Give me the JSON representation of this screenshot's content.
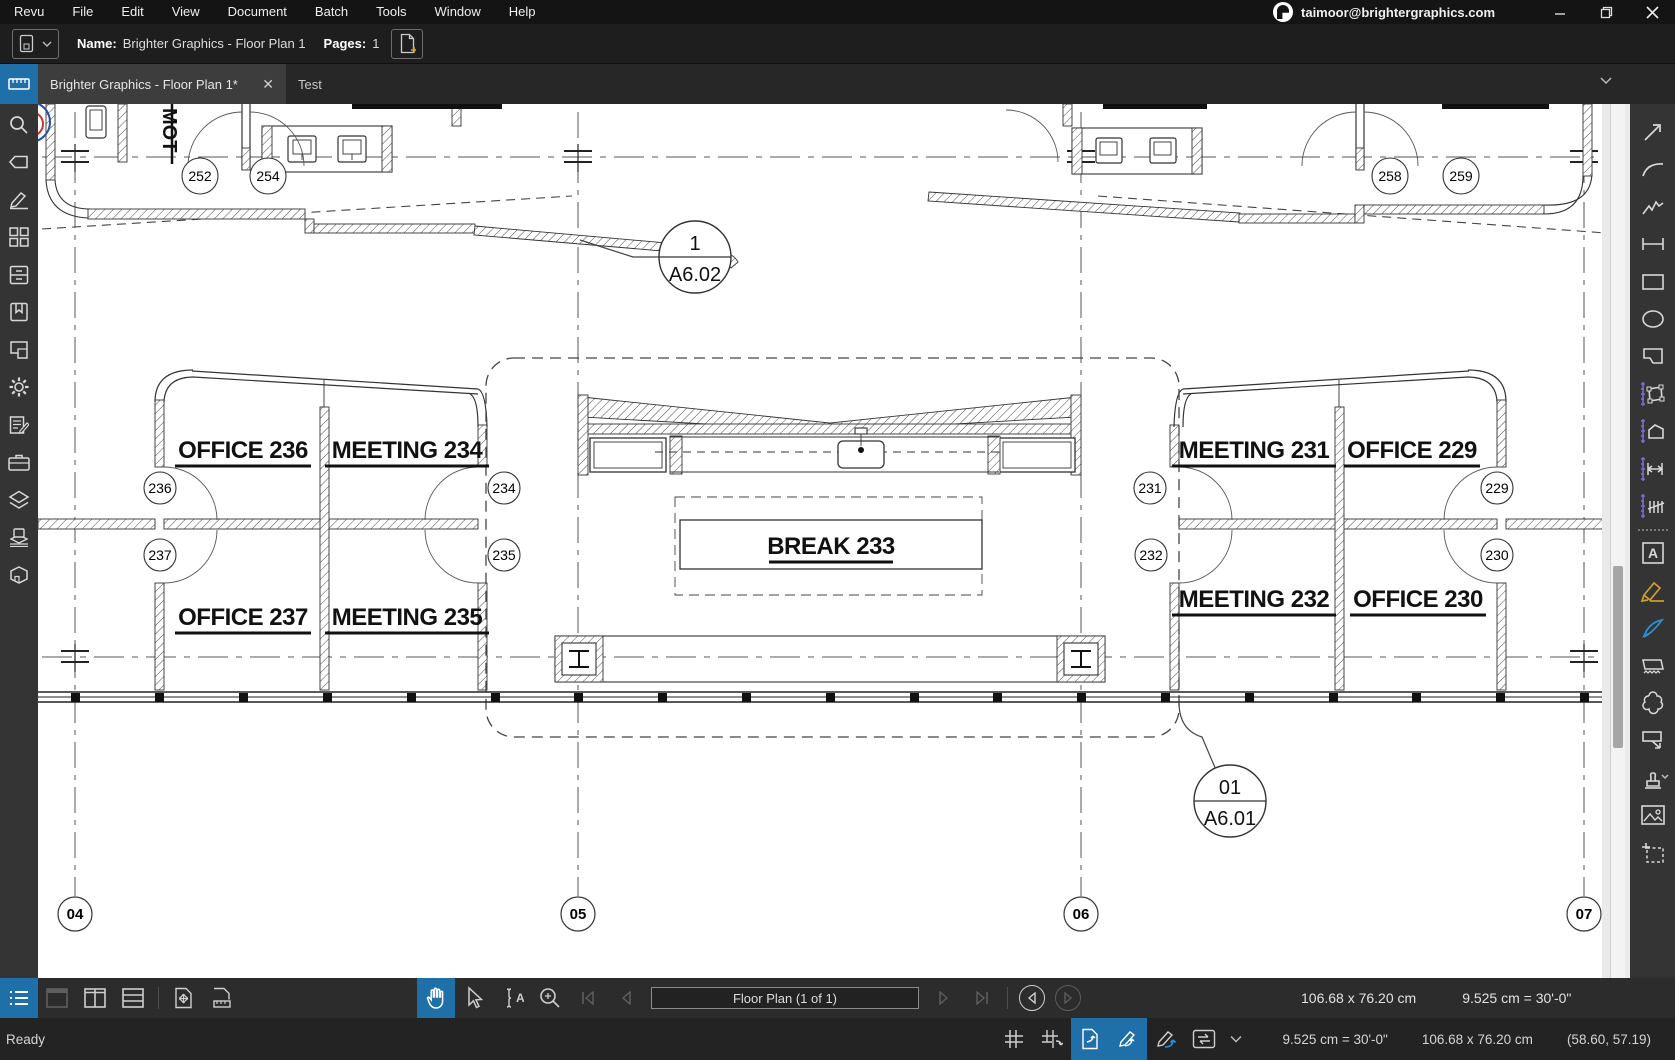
{
  "titlebar": {
    "menus": [
      "Revu",
      "File",
      "Edit",
      "View",
      "Document",
      "Batch",
      "Tools",
      "Window",
      "Help"
    ],
    "account_email": "taimoor@brightergraphics.com",
    "window_icons": [
      "revu-logo",
      "minimize-icon",
      "restore-icon",
      "close-icon"
    ]
  },
  "filebar": {
    "name_label": "Name:",
    "name_value": "Brighter Graphics - Floor Plan 1",
    "pages_label": "Pages:",
    "pages_value": "1",
    "icons": [
      "document-dropdown-icon",
      "new-page-icon"
    ]
  },
  "tabs": {
    "active_label": "Brighter Graphics - Floor Plan 1*",
    "close_glyph": "✕",
    "second_label": "Test",
    "icons": [
      "ruler-tab-icon",
      "chevron-down-icon"
    ]
  },
  "left_panel": {
    "active_icon": "measurements-panel-icon",
    "icons": [
      "search-icon",
      "tag-icon",
      "markup-pen-icon",
      "thumbnails-icon",
      "file-access-icon",
      "bookmarks-icon",
      "spaces-icon",
      "settings-gear-icon",
      "markups-list-icon",
      "tool-chest-icon",
      "layers-icon",
      "sets-icon",
      "3d-model-icon"
    ]
  },
  "right_panel": {
    "icons": [
      "line-icon",
      "arrow-icon",
      "arc-icon",
      "polyline-icon",
      "dimension-icon",
      "rectangle-icon",
      "ellipse-icon",
      "polygon-icon",
      "measure-area-icon",
      "measure-perimeter-icon",
      "measure-length-icon",
      "measure-count-icon",
      "text-box-icon",
      "highlighter-icon",
      "pen-icon",
      "eraser-icon",
      "cloud-icon",
      "callout-icon",
      "stamp-icon",
      "image-icon",
      "snapshot-icon"
    ],
    "accent_purple": "#7b6ed6"
  },
  "toolbar_bottom": {
    "page_field": "Floor Plan (1 of 1)",
    "dims": "106.68 x 76.20 cm",
    "scale": "9.525 cm = 30'-0\"",
    "icons": [
      "markups-list-toggle-icon",
      "single-pane-icon",
      "split-vertical-icon",
      "split-horizontal-icon",
      "fit-page-icon",
      "fit-width-icon",
      "pan-hand-icon",
      "select-cursor-icon",
      "text-select-icon",
      "zoom-icon",
      "first-page-icon",
      "prev-page-icon",
      "next-page-icon",
      "last-page-icon",
      "previous-view-icon",
      "next-view-icon"
    ]
  },
  "statusbar": {
    "ready": "Ready",
    "scale": "9.525 cm = 30'-0\"",
    "dims": "106.68 x 76.20 cm",
    "coords": "(58.60, 57.19)",
    "icons": [
      "grid-icon",
      "snap-to-grid-icon",
      "snap-to-content-icon",
      "snap-to-markup-icon",
      "reuse-tool-icon",
      "sync-views-icon",
      "chevron-down-icon"
    ]
  },
  "colors": {
    "accent_blue": "#1f6fa8",
    "measure_purple": "#7b6ed6",
    "line_dark": "#333333"
  },
  "plan": {
    "rooms": [
      {
        "label": "OFFICE  236"
      },
      {
        "label": "MEETING  234"
      },
      {
        "label": "OFFICE  237"
      },
      {
        "label": "MEETING  235"
      },
      {
        "label": "BREAK  233"
      },
      {
        "label": "MEETING  231"
      },
      {
        "label": "OFFICE  229"
      },
      {
        "label": "MEETING  232"
      },
      {
        "label": "OFFICE  230"
      }
    ],
    "tags": [
      "236",
      "237",
      "234",
      "235",
      "231",
      "232",
      "229",
      "230",
      "252",
      "254",
      "258",
      "259"
    ],
    "grid_bubbles": [
      "04",
      "05",
      "06",
      "07"
    ],
    "callouts": [
      {
        "num": "1",
        "sheet": "A6.02"
      },
      {
        "num": "01",
        "sheet": "A6.01"
      }
    ],
    "vertical_label": "MOT"
  }
}
